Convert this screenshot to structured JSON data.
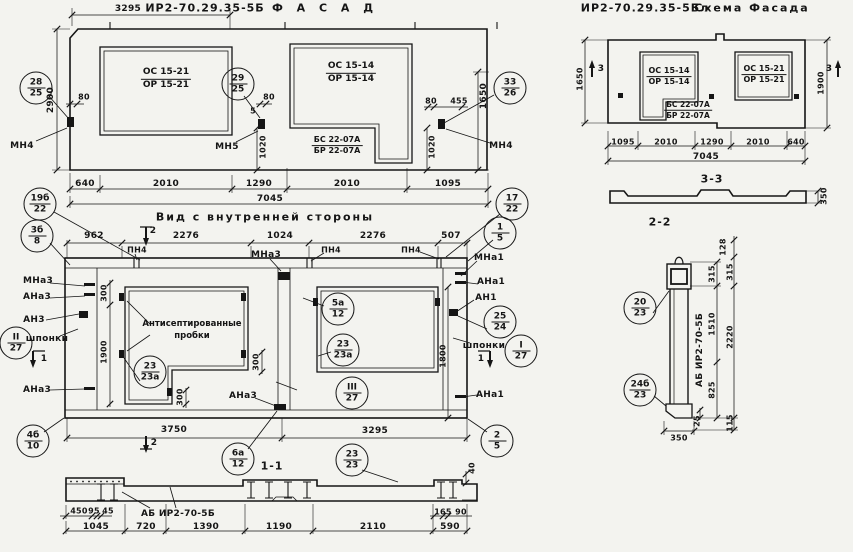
{
  "colors": {
    "paper": "#f3f3ef",
    "ink": "#151515"
  },
  "facade": {
    "title_code": "ИР2-70.29.35-5Б",
    "title_name": "Ф А С А Д",
    "top_dim": "3295",
    "left_dim": "2900",
    "right_dim": "1650",
    "window_left": {
      "top": "ОС 15-21",
      "bottom": "ОР 15-21"
    },
    "window_right": {
      "top": "ОС 15-14",
      "bottom": "ОР 15-14"
    },
    "door_block": {
      "top": "БС 22-07А",
      "bottom": "БР 22-07А"
    },
    "anchor_dims": [
      "80",
      "5",
      "80",
      "80",
      "455",
      "1020",
      "1020"
    ],
    "bottom_dims": [
      "640",
      "2010",
      "1290",
      "2010",
      "1095"
    ],
    "total_dim": "7045",
    "anchor_labels": [
      "МН4",
      "МН5",
      "МН4"
    ],
    "callouts": [
      {
        "t": "28",
        "b": "25"
      },
      {
        "t": "29",
        "b": "25"
      },
      {
        "t": "33",
        "b": "26"
      }
    ]
  },
  "interior": {
    "title": "Вид с внутренней стороны",
    "top_dims": [
      "962",
      "2276",
      "1024",
      "2276",
      "507"
    ],
    "bottom_dims": [
      "3750",
      "3295"
    ],
    "side_dims": [
      "300",
      "1900",
      "300",
      "300",
      "1800"
    ],
    "labels_left": [
      "МНа3",
      "АНа3",
      "АН3",
      "шпонки",
      "АНа3"
    ],
    "labels_right": [
      "МНа1",
      "АНа1",
      "АН1",
      "шпонки",
      "АНа1"
    ],
    "label_center_mna3": "МНа3",
    "label_center_ana3": "АНа3",
    "pn4": "ПН4",
    "plugs_note_line1": "Антисептированные",
    "plugs_note_line2": "пробки",
    "section_marks": {
      "s1": "1",
      "s2": "2"
    },
    "callouts": [
      {
        "t": "19б",
        "b": "22"
      },
      {
        "t": "3б",
        "b": "8"
      },
      {
        "t": "17",
        "b": "22"
      },
      {
        "t": "1",
        "b": "5"
      },
      {
        "t": "25",
        "b": "24"
      },
      {
        "t": "I",
        "b": "27"
      },
      {
        "t": "II",
        "b": "27"
      },
      {
        "t": "III",
        "b": "27"
      },
      {
        "t": "23",
        "b": "23а"
      },
      {
        "t": "23",
        "b": "23а"
      },
      {
        "t": "5а",
        "b": "12"
      },
      {
        "t": "4б",
        "b": "10"
      },
      {
        "t": "6а",
        "b": "12"
      },
      {
        "t": "2",
        "b": "5"
      }
    ]
  },
  "section11": {
    "title": "1-1",
    "beam_label": "АБ ИР2-70-5Б",
    "dims_small": [
      "450",
      "95",
      "45",
      "165",
      "90",
      "40"
    ],
    "dims_main": [
      "1045",
      "720",
      "1390",
      "1190",
      "2110",
      "590"
    ],
    "callout": {
      "t": "23",
      "b": "23"
    }
  },
  "scheme": {
    "title_code": "ИР2-70.29.35-5Бл",
    "title_name": "Схема Фасада",
    "window_left": {
      "top": "ОС 15-14",
      "bottom": "ОР 15-14"
    },
    "window_right": {
      "top": "ОС 15-21",
      "bottom": "ОР 15-21"
    },
    "door_block": {
      "top": "БС 22-07А",
      "bottom": "БР 22-07А"
    },
    "left_dim": "1650",
    "right_dim": "1900",
    "bottom_dims": [
      "1095",
      "2010",
      "1290",
      "2010",
      "640"
    ],
    "total_dim": "7045",
    "section_mark": "3"
  },
  "section33": {
    "title": "3-3",
    "thickness_dim": "350"
  },
  "section22": {
    "title": "2-2",
    "beam_label": "АБ ИР2-70-5Б",
    "dims": [
      "128",
      "315",
      "315",
      "1510",
      "2220",
      "825",
      "115",
      "25",
      "350"
    ],
    "callouts": [
      {
        "t": "20",
        "b": "23"
      },
      {
        "t": "24б",
        "b": "23"
      }
    ]
  }
}
